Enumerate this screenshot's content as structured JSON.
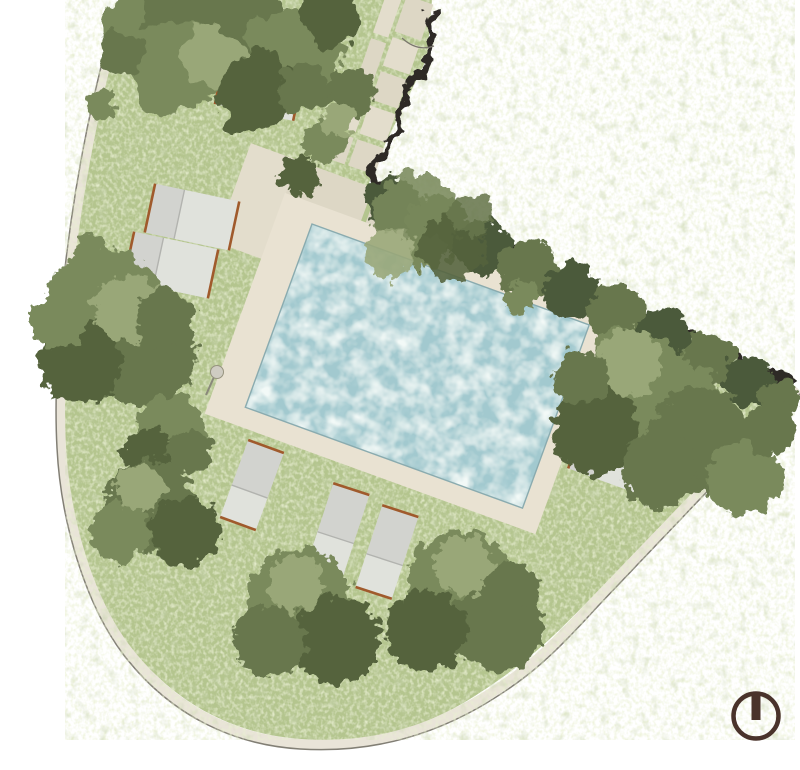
{
  "scene": {
    "title": "garden-site-plan",
    "description": "Top-down watercolor landscape plan of a garden with swimming pool, stone path, lawn, trees and sun loungers beside a building footprint",
    "view": "plan view",
    "background": "#ffffff"
  },
  "colors": {
    "grass_base": "#b4c58e",
    "grass_light": "#cdd9a4",
    "grass_dark": "#93a96f",
    "tree_dark": "#68774e",
    "tree_mid": "#7a8a5c",
    "tree_light": "#99a778",
    "tree_deep": "#55633e",
    "hedge_dark": "#4c5a3a",
    "water_base": "#a2c9cf",
    "water_light": "#e2f1ec",
    "water_deep": "#7fb2ba",
    "water_edge": "#8aabaf",
    "deck": "#e9e2d2",
    "paver": "#ddd7c5",
    "paver_alt": "#e3ddcc",
    "sidewalk": "#e9e4d8",
    "boundary_line": "#827f75",
    "wall": "#2d2b25",
    "lounger": "#d2d3cf",
    "lounger_light": "#e0e2dc",
    "lounger_divider": "#b2b3af",
    "lounger_trim": "#a05a2c",
    "north_icon": "#4a332b",
    "shower": "#cfccc2",
    "shower_line": "#8a887b",
    "gate_line": "#7a776d"
  },
  "features": {
    "lawn": {
      "label": "lawn parcel",
      "shape": "curved wedge plot"
    },
    "pool": {
      "label": "swimming pool",
      "surround": "stone deck",
      "rotation_deg": 20
    },
    "path": {
      "label": "stepping stone path",
      "material": "stone pavers with grass joints"
    },
    "building": {
      "label": "building footprint",
      "edge": "dark wall line, top right"
    },
    "sidewalk": {
      "label": "perimeter sidewalk strip"
    },
    "loungers": {
      "label": "sun loungers",
      "count": 8
    },
    "trees": {
      "label": "tree canopies and hedges",
      "clusters": 10
    },
    "shower": {
      "label": "pool-side fixture on deck"
    },
    "north_indicator": {
      "label": "orientation symbol",
      "glyph": "circle with top tick",
      "position": "bottom-right"
    }
  }
}
